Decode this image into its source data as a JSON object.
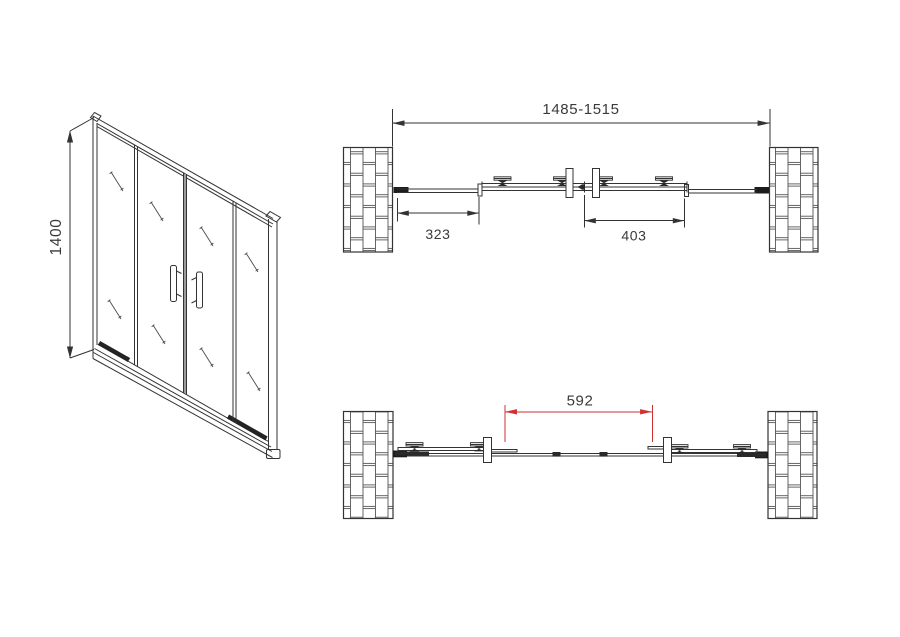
{
  "front_view": {
    "height_label": "1400"
  },
  "plan_closed": {
    "overall_width_label": "1485-1515",
    "fixed_panel_label": "323",
    "door_panel_label": "403"
  },
  "plan_open": {
    "opening_label": "592"
  },
  "colors": {
    "line": "#333333",
    "dimension_red": "#cc3333",
    "background": "#ffffff"
  }
}
